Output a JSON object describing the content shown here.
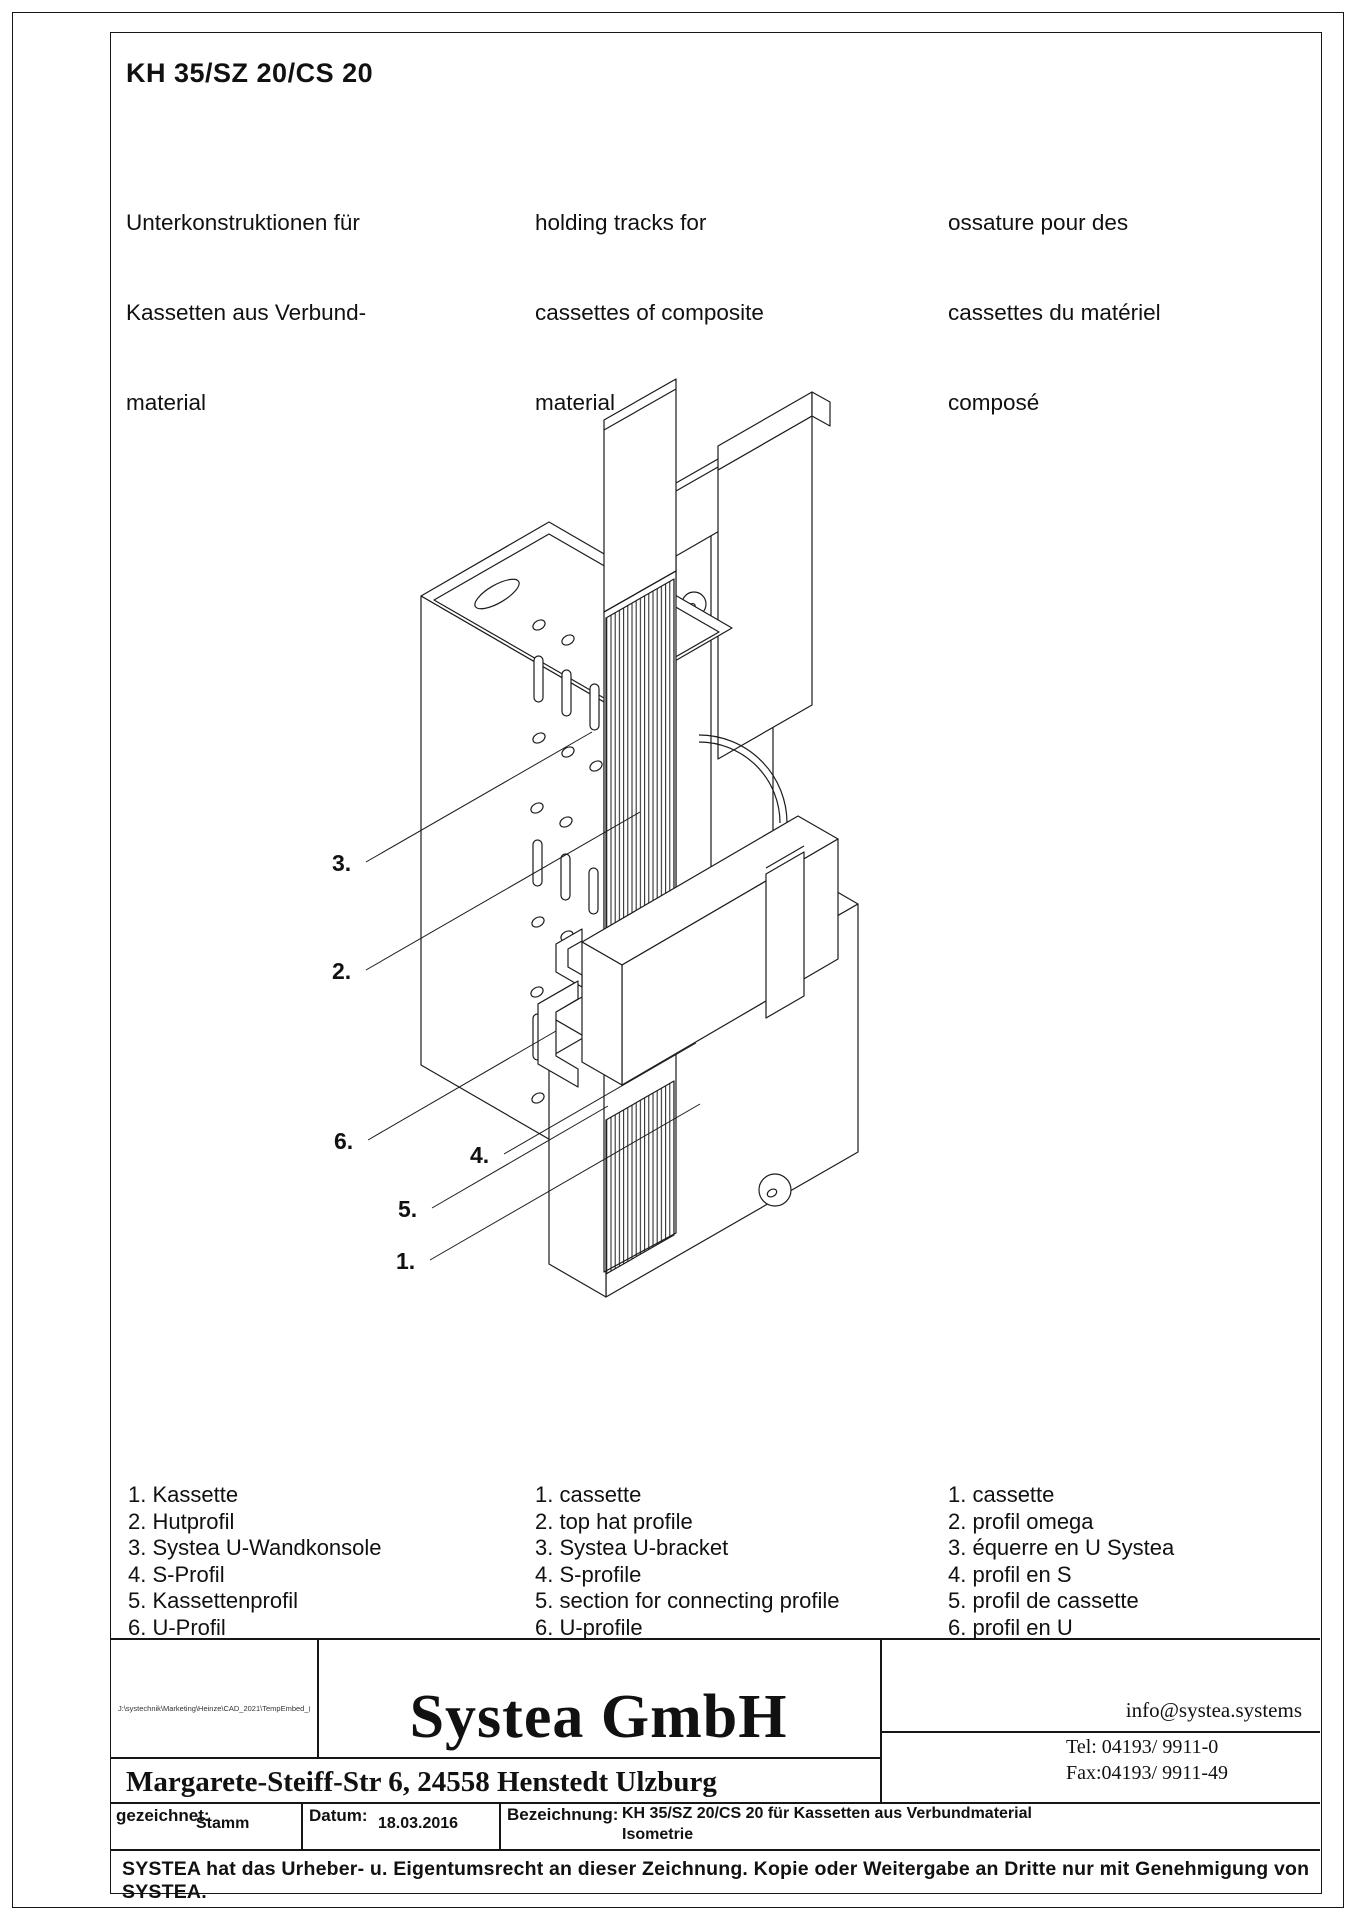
{
  "colors": {
    "background": "#ffffff",
    "line": "#1c1c1c"
  },
  "header": {
    "title": "KH 35/SZ 20/CS 20",
    "descriptions": {
      "de": [
        "Unterkonstruktionen für",
        "Kassetten aus Verbund-",
        "material"
      ],
      "en": [
        "holding tracks for",
        "cassettes of composite",
        "material"
      ],
      "fr": [
        "ossature pour des",
        "cassettes du matériel",
        "composé"
      ]
    }
  },
  "drawing": {
    "labels": [
      "3.",
      "2.",
      "6.",
      "4.",
      "5.",
      "1."
    ]
  },
  "legend": {
    "de": [
      "1. Kassette",
      "2. Hutprofil",
      "3. Systea U-Wandkonsole",
      "4. S-Profil",
      "5. Kassettenprofil",
      "6. U-Profil"
    ],
    "en": [
      "1. cassette",
      "2. top hat profile",
      "3. Systea U-bracket",
      "4. S-profile",
      "5. section for connecting profile",
      "6. U-profile"
    ],
    "fr": [
      "1. cassette",
      "2. profil omega",
      "3. équerre en U Systea",
      "4. profil en S",
      "5. profil de cassette",
      "6. profil en U"
    ]
  },
  "title_block": {
    "path_note": "J:\\systechnik\\Marketing\\Heinze\\CAD_2021\\TempEmbed_(1).jpg",
    "company": "Systea GmbH",
    "email": "info@systea.systems",
    "address": "Margarete-Steiff-Str 6, 24558 Henstedt Ulzburg",
    "tel": "Tel: 04193/ 9911-0",
    "fax": "Fax:04193/ 9911-49",
    "drawn_label": "gezeichnet:",
    "drawn_value": "Stamm",
    "date_label": "Datum:",
    "date_value": "18.03.2016",
    "designation_label": "Bezeichnung:",
    "designation_line1": "KH 35/SZ 20/CS 20 für Kassetten aus Verbundmaterial",
    "designation_line2": "Isometrie",
    "copyright": "SYSTEA hat das Urheber- u. Eigentumsrecht an dieser Zeichnung. Kopie oder Weitergabe an Dritte nur mit Genehmigung von SYSTEA."
  }
}
